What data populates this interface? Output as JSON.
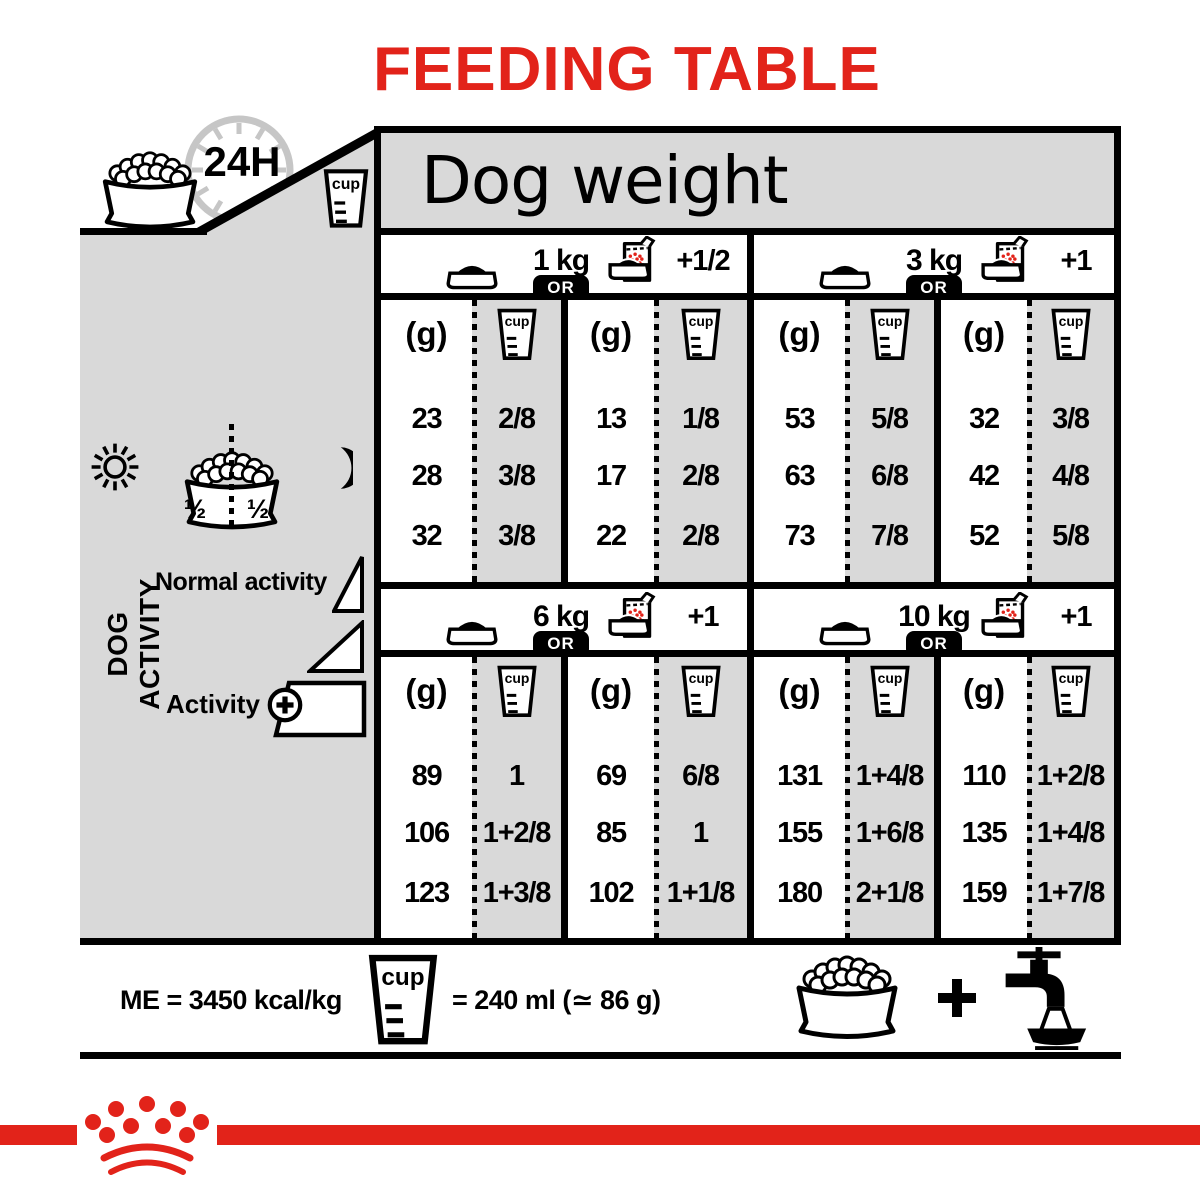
{
  "title": "FEEDING TABLE",
  "header": {
    "dog_weight": "Dog weight",
    "clock": "24H",
    "cup": "cup"
  },
  "sidebar": {
    "label": "DOG ACTIVITY",
    "half_left": "½",
    "half_right": "½",
    "normal_activity": "Normal activity",
    "activity": "Activity"
  },
  "table": {
    "or": "OR",
    "g_unit": "(g)",
    "sections": [
      {
        "weight": "1 kg",
        "mixed_extra": "+1/2",
        "kibble_g": [
          "23",
          "28",
          "32"
        ],
        "kibble_cup": [
          "2/8",
          "3/8",
          "3/8"
        ],
        "mixed_g": [
          "13",
          "17",
          "22"
        ],
        "mixed_cup": [
          "1/8",
          "2/8",
          "2/8"
        ]
      },
      {
        "weight": "3 kg",
        "mixed_extra": "+1",
        "kibble_g": [
          "53",
          "63",
          "73"
        ],
        "kibble_cup": [
          "5/8",
          "6/8",
          "7/8"
        ],
        "mixed_g": [
          "32",
          "42",
          "52"
        ],
        "mixed_cup": [
          "3/8",
          "4/8",
          "5/8"
        ]
      },
      {
        "weight": "6 kg",
        "mixed_extra": "+1",
        "kibble_g": [
          "89",
          "106",
          "123"
        ],
        "kibble_cup": [
          "1",
          "1+2/8",
          "1+3/8"
        ],
        "mixed_g": [
          "69",
          "85",
          "102"
        ],
        "mixed_cup": [
          "6/8",
          "1",
          "1+1/8"
        ]
      },
      {
        "weight": "10 kg",
        "mixed_extra": "+1",
        "kibble_g": [
          "131",
          "155",
          "180"
        ],
        "kibble_cup": [
          "1+4/8",
          "1+6/8",
          "2+1/8"
        ],
        "mixed_g": [
          "110",
          "135",
          "159"
        ],
        "mixed_cup": [
          "1+2/8",
          "1+4/8",
          "1+7/8"
        ]
      }
    ]
  },
  "footer": {
    "me": "ME = 3450 kcal/kg",
    "cup_equiv": "= 240 ml (≃ 86 g)"
  },
  "colors": {
    "brand_red": "#e2231a",
    "panel_gray": "#d9d9d9",
    "clock_gray": "#c6c6c6",
    "black": "#000000"
  }
}
